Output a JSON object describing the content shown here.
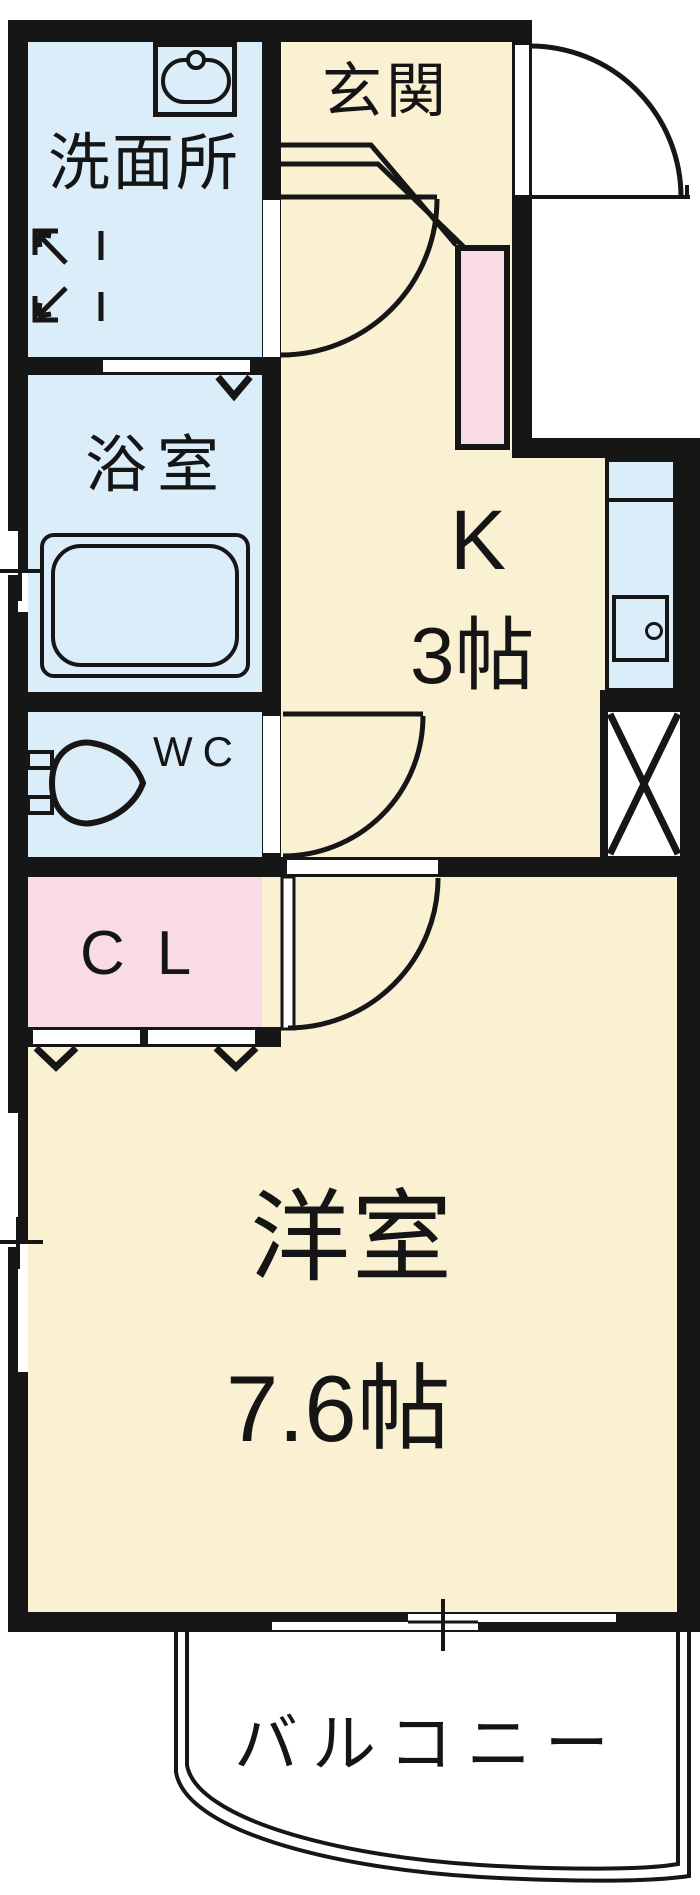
{
  "colors": {
    "wall": "#161616",
    "cream": "#FAF1D2",
    "blue": "#DBEDF8",
    "pink": "#F9DBE6"
  },
  "rooms": {
    "entrance": {
      "label": "玄関"
    },
    "washroom": {
      "label": "洗面所"
    },
    "bathroom": {
      "label": "浴室"
    },
    "toilet": {
      "label": "WC"
    },
    "closet": {
      "label": "CL"
    },
    "kitchen": {
      "label": "K",
      "size": "3帖"
    },
    "western_room": {
      "label": "洋室",
      "size": "7.6帖"
    },
    "balcony": {
      "label": "バルコニー"
    }
  },
  "icons": {
    "bathtub": "double-rounded-rect",
    "toilet_bowl": "oval-bowl-with-tank",
    "washbasin": "oval-basin-with-faucet-circle",
    "kitchen_sink": "square-basin-with-faucet-circle",
    "washer_space": "corner-brackets-with-diagonal-arrows",
    "dead_space": "x-cross-box",
    "door_swing": "quarter-arc",
    "sliding_window": "offset-double-white-strip",
    "folding_door_mark": "open-triangle-down"
  }
}
